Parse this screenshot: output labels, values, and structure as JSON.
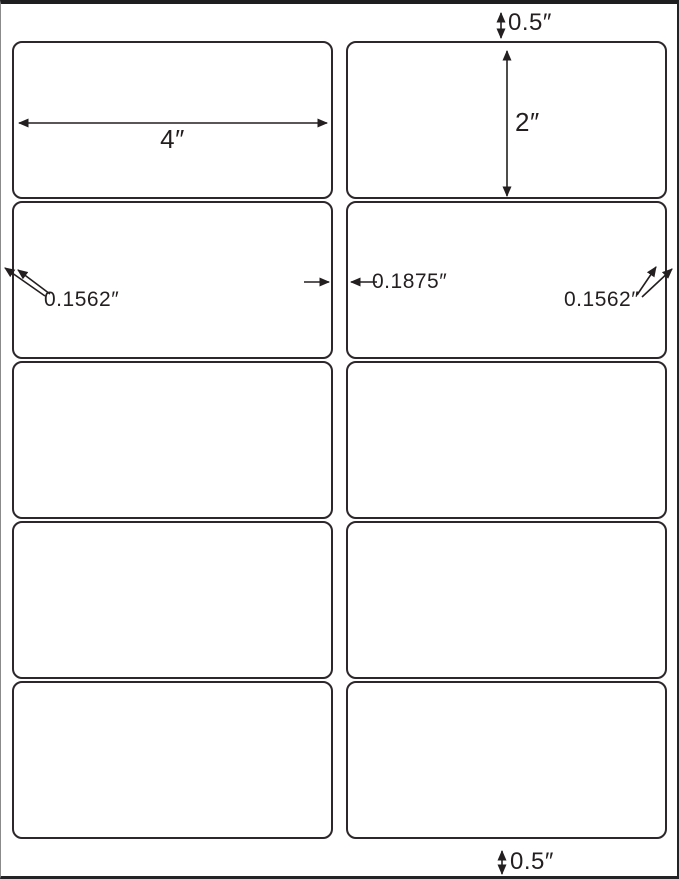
{
  "sheet": {
    "rows": 5,
    "columns": 2
  },
  "dims": {
    "top_margin": "0.5″",
    "label_width": "4″",
    "label_height": "2″",
    "left_margin": "0.1562″",
    "column_gap": "0.1875″",
    "right_margin": "0.1562″",
    "bottom_margin": "0.5″"
  },
  "colors": {
    "line": "#231f20",
    "label_border": "#2b272a",
    "background": "#ffffff"
  }
}
